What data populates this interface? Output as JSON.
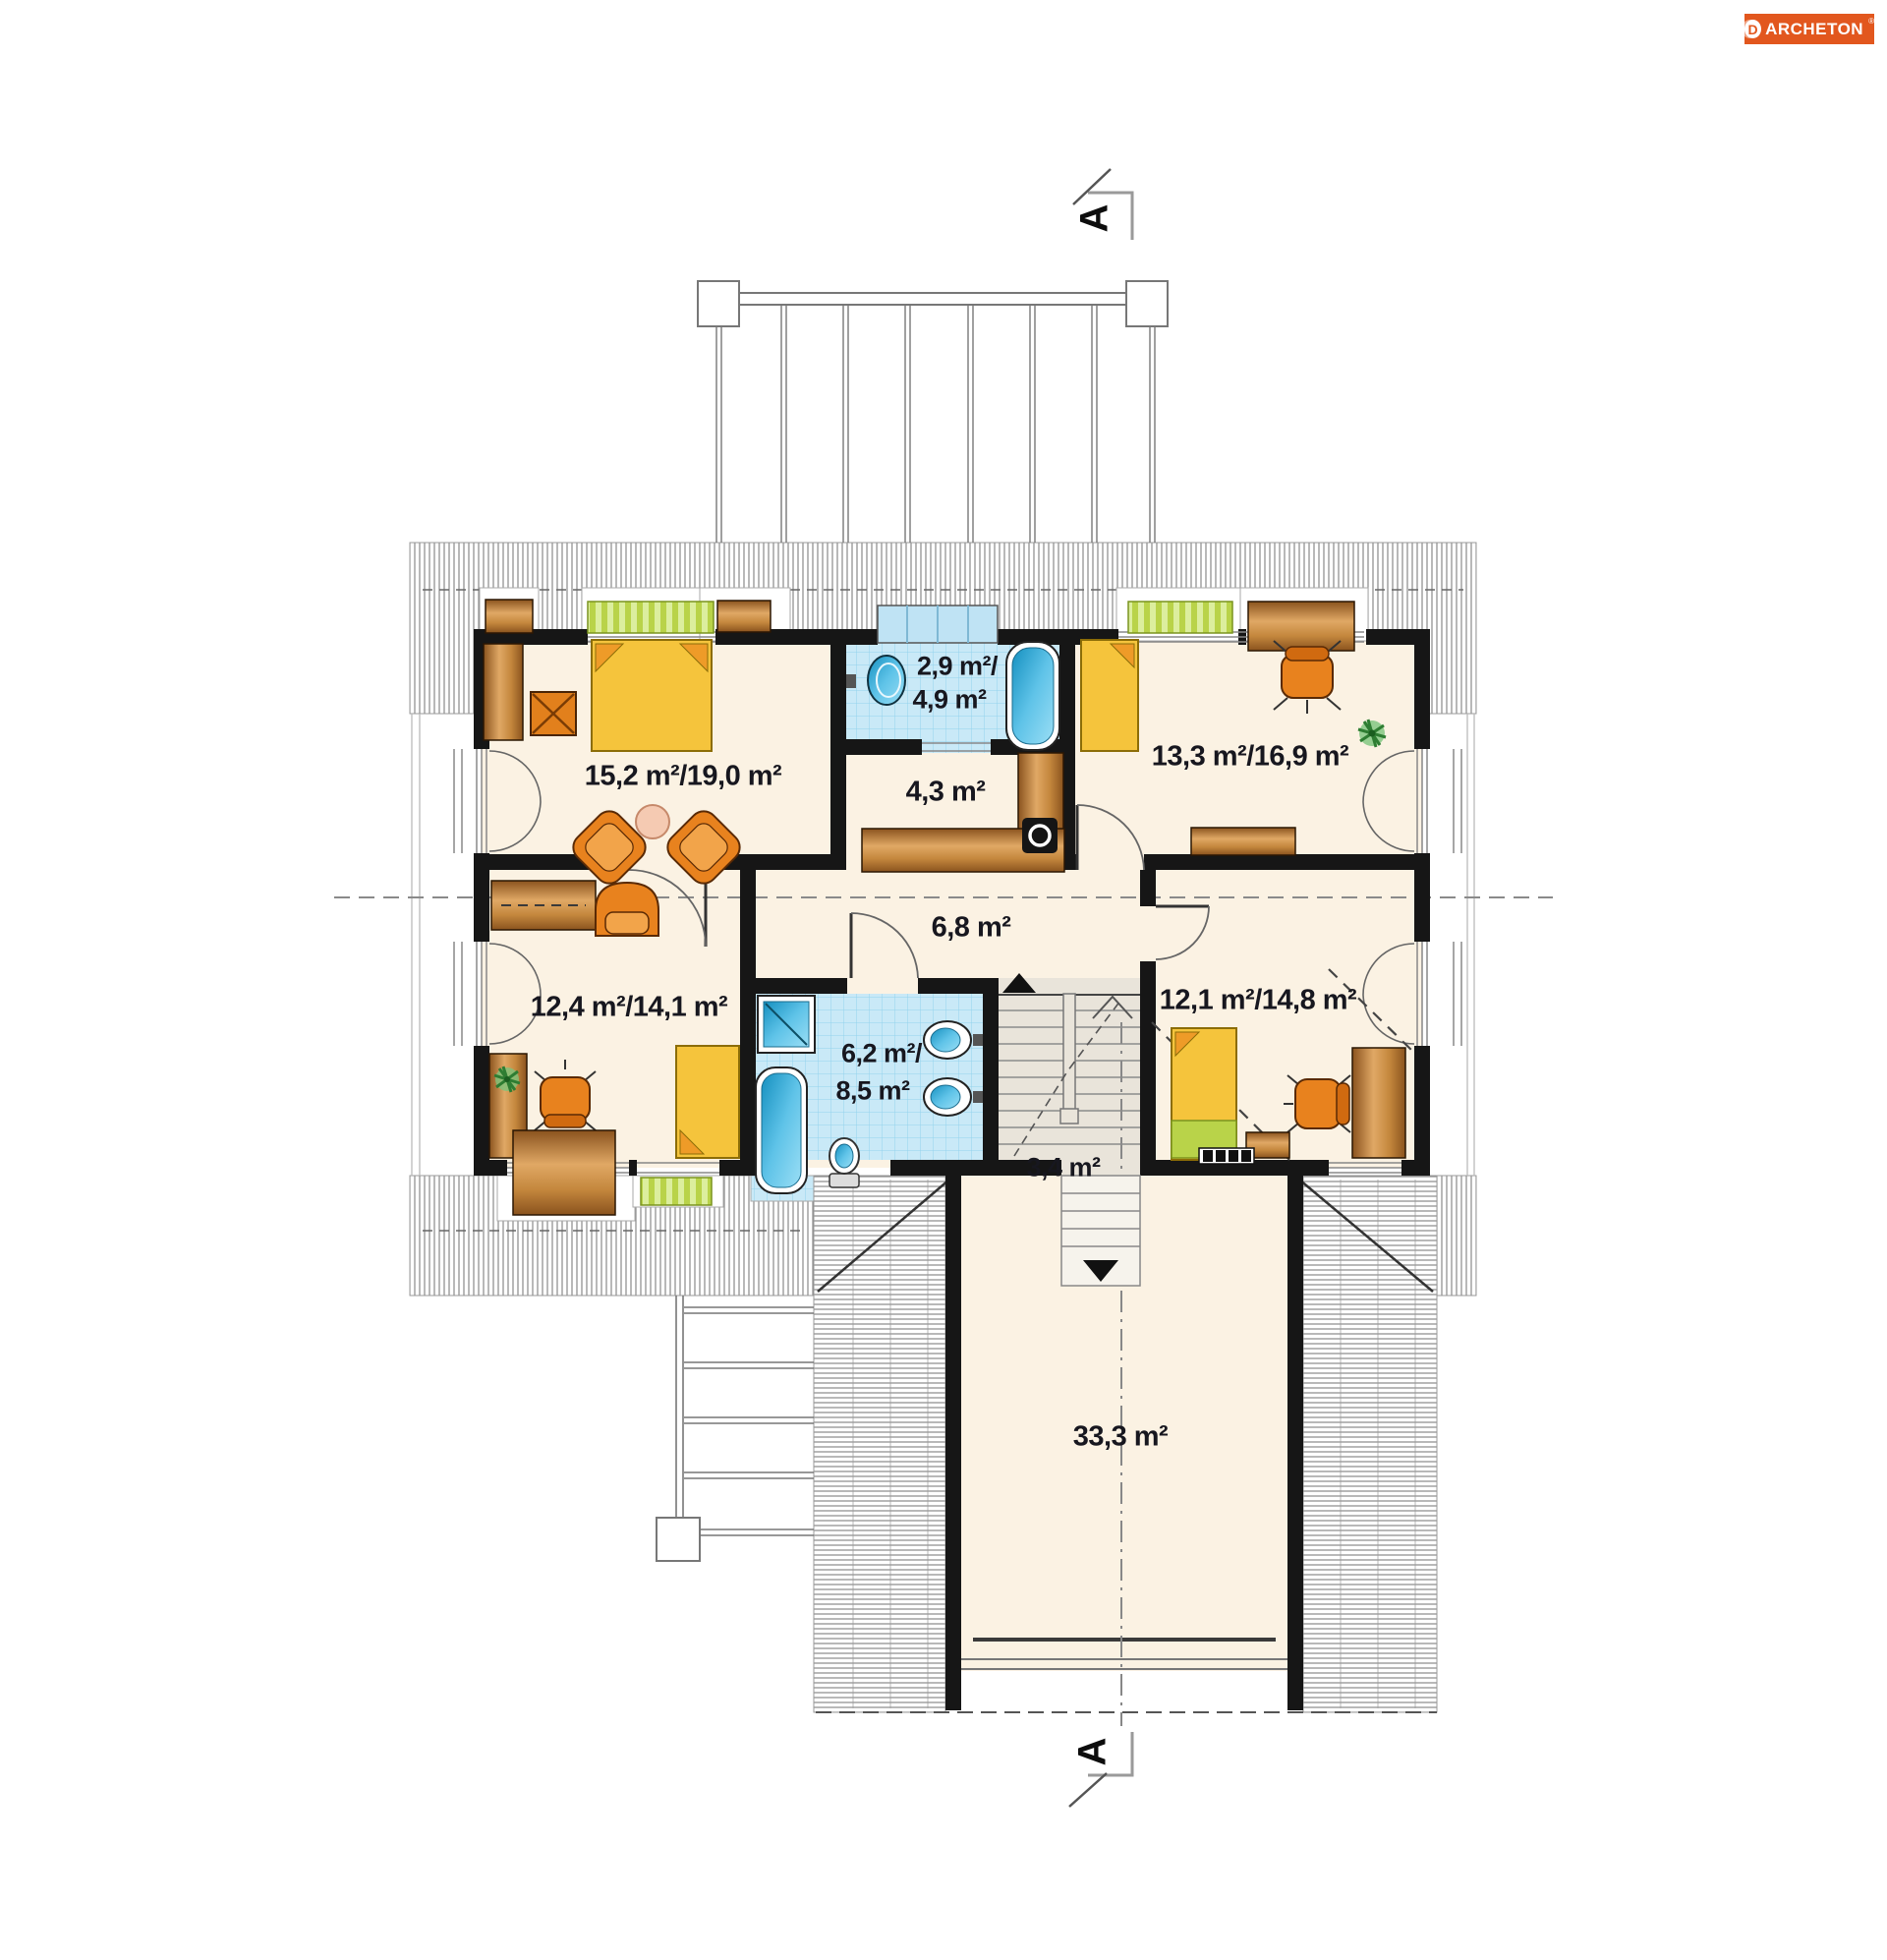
{
  "logo": {
    "icon_letter": "D",
    "text": "ARCHETON",
    "registered": "®",
    "bg_color": "#e2571e",
    "text_color": "#ffffff"
  },
  "section_marker": {
    "label": "A"
  },
  "labels": {
    "bath_top_line1": "2,9 m²/",
    "bath_top_line2": "4,9 m²",
    "corridor": "4,3 m²",
    "bedroom_right_top": "13,3 m²/16,9 m²",
    "bedroom_left_top": "15,2 m²/19,0 m²",
    "hall": "6,8 m²",
    "bedroom_left_bottom": "12,4 m²/14,1 m²",
    "bath_bottom_line1": "6,2 m²/",
    "bath_bottom_line2": "8,5 m²",
    "bedroom_right_bottom": "12,1 m²/14,8 m²",
    "landing": "3,4 m²",
    "garage": "33,3 m²"
  },
  "colors": {
    "wall": "#161616",
    "floor": "#fbf2e3",
    "stair_floor": "#e9e4da",
    "tile": "#c9e9f7",
    "tile_line": "#93d2ec",
    "bed_yellow": "#f5c43c",
    "pillow_orange": "#ee9b28",
    "furniture_brown": "#c4873d",
    "chair_orange": "#e8821e",
    "fixture_blue": "#2aa4d4",
    "bench_green": "#b9d349",
    "hatch_line": "#8a8a8a",
    "logo_orange": "#e2571e"
  }
}
